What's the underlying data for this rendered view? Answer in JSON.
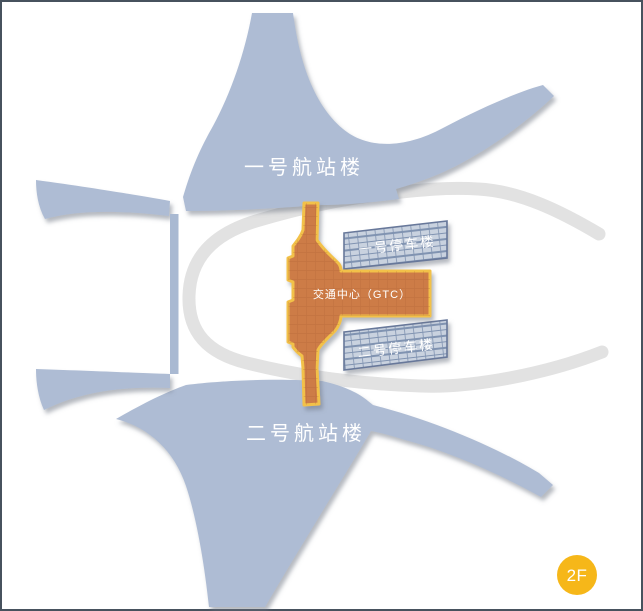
{
  "map": {
    "terminal1_label": "一号航站楼",
    "terminal2_label": "二号航站楼",
    "parking1_label": "一号停车楼",
    "parking2_label": "二号停车楼",
    "gtc_label": "交通中心（GTC）",
    "floor_badge_label": "2F",
    "colors": {
      "background": "#ffffff",
      "frame_border": "#47525e",
      "terminal_fill": "#aebcd4",
      "connector_fill": "#a9b9d2",
      "road_fill": "#e2e2e2",
      "parking_fill": "#c9d2df",
      "parking_line": "#8093b1",
      "parking_border": "#67789a",
      "gtc_fill": "#cd7c46",
      "gtc_texture": "#a55a2e",
      "gtc_border": "#f2c14a",
      "badge_fill": "#f6b719",
      "label_color": "#ffffff",
      "shadow": "#6b7280"
    }
  }
}
